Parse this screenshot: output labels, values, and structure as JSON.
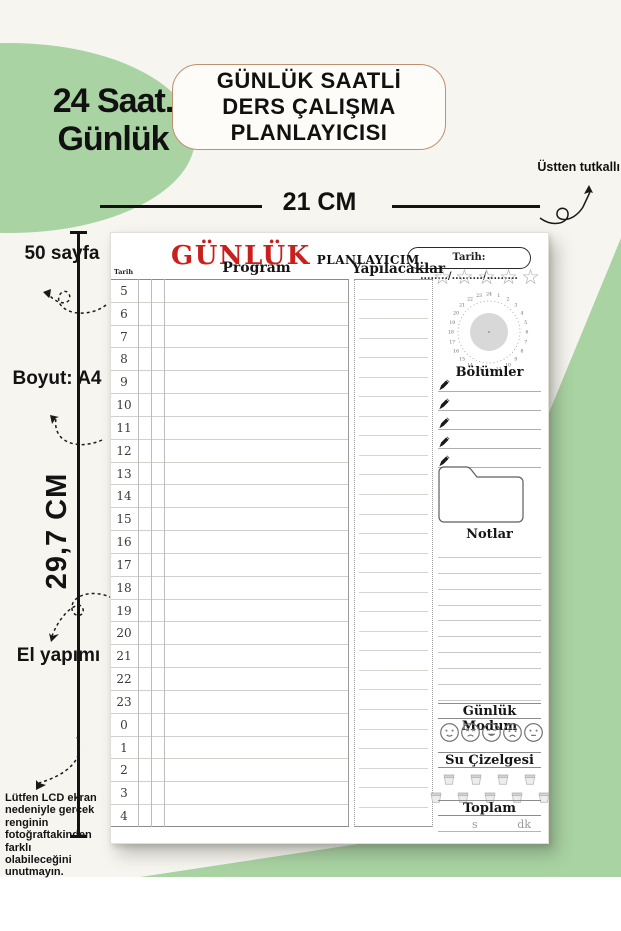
{
  "colors": {
    "green": "#a9d3a2",
    "brand_red": "#c9201d",
    "title_border": "#c08f72",
    "paper": "#f7f5ef"
  },
  "badge": {
    "line1": "24 Saat.",
    "line2": "Günlük"
  },
  "title_box": {
    "lines": [
      "GÜNLÜK SAATLİ",
      "DERS ÇALIŞMA",
      "PLANLAYICISI"
    ]
  },
  "annotations": {
    "top_right": "Üstten tutkallı",
    "width_label": "21 CM",
    "height_label": "29,7 CM",
    "pages_label": "50 sayfa",
    "size_label": "Boyut: A4",
    "handmade_label": "El yapımı",
    "disclaimer_lines": [
      "Lütfen LCD ekran",
      "nedeniyle gerçek",
      "renginin",
      "fotoğraftakinden",
      "farklı olabileceğini",
      "unutmayın."
    ]
  },
  "page": {
    "brand_red": "GÜNLÜK",
    "brand_rest": "PLANLAYICIM.",
    "date_label": "Tarih: ......../........./.........",
    "stars_count": 5,
    "table": {
      "date_col_label": "Tarih",
      "program_header": "Program",
      "hours": [
        "5",
        "6",
        "7",
        "8",
        "9",
        "10",
        "11",
        "12",
        "13",
        "14",
        "15",
        "16",
        "17",
        "18",
        "19",
        "20",
        "21",
        "22",
        "23",
        "0",
        "1",
        "2",
        "3",
        "4"
      ]
    },
    "todo": {
      "header": "Yapılacaklar",
      "line_count": 28
    },
    "sidebar": {
      "clock_numbers": [
        "1",
        "2",
        "3",
        "4",
        "5",
        "6",
        "7",
        "8",
        "9",
        "10",
        "11",
        "12",
        "13",
        "14",
        "15",
        "16",
        "17",
        "18",
        "19",
        "20",
        "21",
        "22",
        "23",
        "24"
      ],
      "sections_header": "Bölümler",
      "section_line_count": 5,
      "notes_header": "Notlar",
      "note_line_count": 10,
      "mood_header": "Günlük Modum",
      "moods": [
        "smile",
        "angry",
        "grin",
        "cry",
        "plain"
      ],
      "water_header": "Su Çizelgesi",
      "water_rows": [
        4,
        5
      ],
      "total_header": "Toplam",
      "total_units": {
        "hours": "s",
        "minutes": "dk"
      }
    }
  }
}
